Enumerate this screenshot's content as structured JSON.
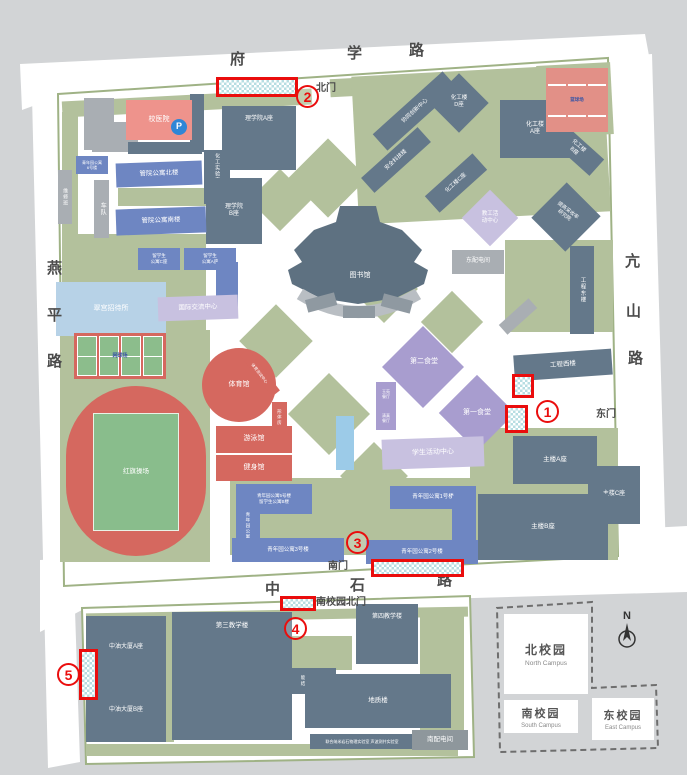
{
  "colors": {
    "background": "#d2d4d6",
    "campus": "#ffffff",
    "lawn": "#b3c19c",
    "campus_border": "#9fb285",
    "academic_building": "#64788a",
    "dormitory": "#6e86c2",
    "hotel": "#b7d2e7",
    "hospital": "#ee938c",
    "sports": "#d5685f",
    "canteen": "#a89dcf",
    "activity": "#c8c1e0",
    "marker_red": "#ea0d0d",
    "marker_fill": "#b7dde2",
    "parking_blue": "#2f86d6"
  },
  "road_labels": [
    {
      "id": "road-fuxue-char-1",
      "text": "府",
      "x": 230,
      "y": 48
    },
    {
      "id": "road-fuxue-char-2",
      "text": "学",
      "x": 347,
      "y": 42
    },
    {
      "id": "road-fuxue-char-3",
      "text": "路",
      "x": 409,
      "y": 39
    },
    {
      "id": "road-yanping-char-1",
      "text": "燕",
      "x": 47,
      "y": 257
    },
    {
      "id": "road-yanping-char-2",
      "text": "平",
      "x": 47,
      "y": 304
    },
    {
      "id": "road-yanping-char-3",
      "text": "路",
      "x": 47,
      "y": 350
    },
    {
      "id": "road-kangshan-char-1",
      "text": "亢",
      "x": 625,
      "y": 250
    },
    {
      "id": "road-kangshan-char-2",
      "text": "山",
      "x": 626,
      "y": 300
    },
    {
      "id": "road-kangshan-char-3",
      "text": "路",
      "x": 628,
      "y": 347
    },
    {
      "id": "road-zhongshi-char-1",
      "text": "中",
      "x": 265,
      "y": 578
    },
    {
      "id": "road-zhongshi-char-2",
      "text": "石",
      "x": 350,
      "y": 574
    },
    {
      "id": "road-zhongshi-char-3",
      "text": "路",
      "x": 437,
      "y": 569
    }
  ],
  "gates": [
    {
      "id": "gate-north",
      "label": "北门",
      "x": 316,
      "y": 79
    },
    {
      "id": "gate-east",
      "label": "东门",
      "x": 596,
      "y": 405
    },
    {
      "id": "gate-south",
      "label": "南门",
      "x": 328,
      "y": 557
    },
    {
      "id": "gate-south-campus-north",
      "label": "南校园北门",
      "x": 316,
      "y": 593
    }
  ],
  "buildings": [
    {
      "id": "building-unnamed-1",
      "label": "",
      "x": 84,
      "y": 98,
      "w": 30,
      "h": 52,
      "t": "plain"
    },
    {
      "id": "building-unnamed-2",
      "label": "",
      "x": 92,
      "y": 122,
      "w": 46,
      "h": 30,
      "t": "plain"
    },
    {
      "id": "building-unnamed-3",
      "label": "",
      "x": 128,
      "y": 142,
      "w": 74,
      "h": 12,
      "t": "academic"
    },
    {
      "id": "building-unnamed-4",
      "label": "",
      "x": 190,
      "y": 94,
      "w": 14,
      "h": 58,
      "t": "academic"
    },
    {
      "id": "building-xiaoyiyuan",
      "label": "校医院",
      "x": 126,
      "y": 100,
      "w": 66,
      "h": 40,
      "t": "pink",
      "fs": 7
    },
    {
      "id": "parking-icon",
      "label": "P",
      "x": 171,
      "y": 119,
      "w": 16,
      "h": 16,
      "t": "picon",
      "fs": 9
    },
    {
      "id": "building-lixueyuan-a",
      "label": "理学院A座",
      "x": 222,
      "y": 106,
      "w": 74,
      "h": 64,
      "t": "academic",
      "fs": 6,
      "lp": "top"
    },
    {
      "id": "building-huagong-shiyan",
      "label": "化工实验实践中心",
      "x": 204,
      "y": 150,
      "w": 26,
      "h": 54,
      "t": "academic",
      "fs": 5,
      "vert": true
    },
    {
      "id": "building-lixueyuan-b",
      "label": "理学院\nB座",
      "x": 206,
      "y": 178,
      "w": 56,
      "h": 66,
      "t": "academic",
      "fs": 6
    },
    {
      "id": "building-weixiuban",
      "label": "维修班",
      "x": 58,
      "y": 170,
      "w": 14,
      "h": 54,
      "t": "plain",
      "fs": 5,
      "vert": true
    },
    {
      "id": "building-chedui",
      "label": "车队",
      "x": 94,
      "y": 180,
      "w": 15,
      "h": 58,
      "t": "plain",
      "fs": 6,
      "vert": true
    },
    {
      "id": "building-guanyuan-gongyu-bei",
      "label": "管院公寓北楼",
      "x": 116,
      "y": 162,
      "w": 86,
      "h": 24,
      "t": "dorm",
      "fs": 6.5,
      "rot": -2
    },
    {
      "id": "building-guanyuan-gongyu-nan",
      "label": "管院公寓南楼",
      "x": 116,
      "y": 208,
      "w": 90,
      "h": 26,
      "t": "dorm",
      "fs": 6.5,
      "rot": -2
    },
    {
      "id": "building-qingnianyuan-gongyu-6",
      "label": "青年园公寓\n6号楼",
      "x": 76,
      "y": 156,
      "w": 32,
      "h": 18,
      "t": "dorm",
      "fs": 4
    },
    {
      "id": "building-liuxuesheng-gongyu-c",
      "label": "留学生\n公寓C座",
      "x": 138,
      "y": 248,
      "w": 42,
      "h": 22,
      "t": "dorm",
      "fs": 4.5
    },
    {
      "id": "building-liuxuesheng-gongyu-a",
      "label": "留学生\n公寓A座",
      "x": 184,
      "y": 248,
      "w": 52,
      "h": 22,
      "t": "dorm",
      "fs": 4.5
    },
    {
      "id": "building-liuxuesheng-gongyu-a-wing",
      "label": "",
      "x": 216,
      "y": 262,
      "w": 22,
      "h": 52,
      "t": "dorm"
    },
    {
      "id": "building-cuigong-zhaodaisuo",
      "label": "翠宫招待所",
      "x": 56,
      "y": 282,
      "w": 110,
      "h": 54,
      "t": "lightblue",
      "fs": 7
    },
    {
      "id": "building-guoji-jiaoliu-zhongxin",
      "label": "国际交流中心",
      "x": 158,
      "y": 296,
      "w": 80,
      "h": 24,
      "t": "lightpurple",
      "fs": 6.5,
      "rot": -2
    },
    {
      "id": "tennis-courts",
      "label": "网球场",
      "x": 74,
      "y": 333,
      "w": 92,
      "h": 46,
      "t": "tennis",
      "fs": 5
    },
    {
      "id": "hongqi-track",
      "label": "",
      "x": 66,
      "y": 386,
      "w": 140,
      "h": 170,
      "t": "track"
    },
    {
      "id": "hongqi-caochang",
      "label": "红旗操场",
      "x": 93,
      "y": 413,
      "w": 86,
      "h": 118,
      "t": "pitch",
      "fs": 6.5
    },
    {
      "id": "building-tiyuguan",
      "label": "体育馆",
      "x": 202,
      "y": 348,
      "w": 74,
      "h": 74,
      "t": "red",
      "fs": 7,
      "circle": true
    },
    {
      "id": "building-tiyu-ceshi-zhongxin",
      "label": "体育测试中心",
      "x": 234,
      "y": 368,
      "w": 52,
      "h": 10,
      "t": "red",
      "fs": 4,
      "rot": 52
    },
    {
      "id": "building-xingtifang",
      "label": "形体房",
      "x": 272,
      "y": 402,
      "w": 15,
      "h": 30,
      "t": "red",
      "fs": 4.5,
      "vert": true
    },
    {
      "id": "building-youyongguan",
      "label": "游泳馆",
      "x": 216,
      "y": 426,
      "w": 76,
      "h": 27,
      "t": "red",
      "fs": 7
    },
    {
      "id": "building-jianshenguan",
      "label": "健身馆",
      "x": 216,
      "y": 455,
      "w": 76,
      "h": 26,
      "t": "red",
      "fs": 7
    },
    {
      "id": "pond",
      "label": "",
      "x": 336,
      "y": 416,
      "w": 18,
      "h": 54,
      "t": "water"
    },
    {
      "id": "library-label",
      "label": "图书馆",
      "x": 338,
      "y": 270,
      "w": 44,
      "h": 12,
      "t": "label",
      "fs": 7
    },
    {
      "id": "building-dier-shitang",
      "label": "",
      "x": 394,
      "y": 338,
      "w": 58,
      "h": 58,
      "t": "canteen",
      "rot": 45
    },
    {
      "id": "dier-shitang-label",
      "label": "第二食堂",
      "x": 398,
      "y": 356,
      "w": 52,
      "h": 12,
      "t": "label",
      "fs": 7
    },
    {
      "id": "building-yuyuan-canting",
      "label": "玉苑\n餐厅",
      "x": 376,
      "y": 382,
      "w": 20,
      "h": 24,
      "t": "canteen",
      "fs": 4
    },
    {
      "id": "building-qingzhen-canting",
      "label": "清真\n餐厅",
      "x": 376,
      "y": 406,
      "w": 20,
      "h": 24,
      "t": "canteen",
      "fs": 4
    },
    {
      "id": "building-diyi-shitang",
      "label": "",
      "x": 450,
      "y": 386,
      "w": 54,
      "h": 54,
      "t": "canteen",
      "rot": 45
    },
    {
      "id": "diyi-shitang-label",
      "label": "第一食堂",
      "x": 452,
      "y": 407,
      "w": 50,
      "h": 12,
      "t": "label",
      "fs": 7
    },
    {
      "id": "building-xuesheng-huodong-zhongxin",
      "label": "学生活动中心",
      "x": 382,
      "y": 438,
      "w": 102,
      "h": 30,
      "t": "lightpurple",
      "fs": 7,
      "rot": -2
    },
    {
      "id": "building-jiaogong-huodong-zhongxin",
      "label": "",
      "x": 470,
      "y": 198,
      "w": 40,
      "h": 40,
      "t": "lightpurple",
      "rot": 45
    },
    {
      "id": "jiaogong-huodong-label",
      "label": "教工活\n动中心",
      "x": 472,
      "y": 206,
      "w": 36,
      "h": 24,
      "t": "label",
      "fs": 5.5
    },
    {
      "id": "building-dongpeidianjian",
      "label": "东配电间",
      "x": 452,
      "y": 250,
      "w": 52,
      "h": 24,
      "t": "plain",
      "fs": 6
    },
    {
      "id": "building-tigao-caishoulv",
      "label": "",
      "x": 542,
      "y": 192,
      "w": 48,
      "h": 50,
      "t": "academic",
      "rot": 45
    },
    {
      "id": "tigao-caishoulv-label",
      "label": "提高采收率\n研究院",
      "x": 540,
      "y": 202,
      "w": 52,
      "h": 22,
      "t": "label",
      "fs": 5,
      "rot": 38
    },
    {
      "id": "building-huagonglou-a",
      "label": "化工楼\nA座",
      "x": 500,
      "y": 100,
      "w": 70,
      "h": 58,
      "t": "academic",
      "fs": 6
    },
    {
      "id": "building-huagonglou-b",
      "label": "化工楼\nB座",
      "x": 548,
      "y": 138,
      "w": 56,
      "h": 22,
      "t": "academic",
      "fs": 5.5,
      "rot": 42
    },
    {
      "id": "building-huagonglou-c",
      "label": "化工楼C座",
      "x": 424,
      "y": 172,
      "w": 64,
      "h": 22,
      "t": "academic",
      "fs": 5.5,
      "rot": -42
    },
    {
      "id": "building-huagonglou-d",
      "label": "",
      "x": 438,
      "y": 82,
      "w": 42,
      "h": 42,
      "t": "academic",
      "rot": 45
    },
    {
      "id": "huagonglou-d-label",
      "label": "化工楼\nD座",
      "x": 438,
      "y": 90,
      "w": 42,
      "h": 24,
      "t": "label",
      "fs": 5.5
    },
    {
      "id": "building-xietong-chuangxin-zhongxin",
      "label": "协同创新中心",
      "x": 368,
      "y": 100,
      "w": 94,
      "h": 22,
      "t": "academic",
      "fs": 5.5,
      "rot": -42
    },
    {
      "id": "building-anquan-kejilou",
      "label": "安全科技楼",
      "x": 358,
      "y": 150,
      "w": 76,
      "h": 20,
      "t": "academic",
      "fs": 5.5,
      "rot": -42
    },
    {
      "id": "basketball-courts",
      "label": "篮球场",
      "x": 546,
      "y": 68,
      "w": 62,
      "h": 64,
      "t": "basketball",
      "fs": 4.5
    },
    {
      "id": "building-gongcheng-donglou",
      "label": "工程东楼",
      "x": 570,
      "y": 246,
      "w": 24,
      "h": 88,
      "t": "academic",
      "fs": 5.5,
      "vert": true
    },
    {
      "id": "building-unnamed-5",
      "label": "",
      "x": 498,
      "y": 310,
      "w": 40,
      "h": 13,
      "t": "plain",
      "rot": -42
    },
    {
      "id": "building-gongcheng-xilou",
      "label": "工程西楼",
      "x": 514,
      "y": 352,
      "w": 98,
      "h": 26,
      "t": "academic",
      "fs": 6.5,
      "rot": -4
    },
    {
      "id": "building-zhulou-a",
      "label": "主楼A座",
      "x": 513,
      "y": 436,
      "w": 84,
      "h": 48,
      "t": "academic",
      "fs": 6.5
    },
    {
      "id": "building-zhulou-c",
      "label": "主楼C座",
      "x": 588,
      "y": 466,
      "w": 52,
      "h": 58,
      "t": "academic",
      "fs": 6
    },
    {
      "id": "building-zhulou-b",
      "label": "主楼B座",
      "x": 478,
      "y": 494,
      "w": 130,
      "h": 66,
      "t": "academic",
      "fs": 6.5
    },
    {
      "id": "building-qingnianyuan-gongyu-1",
      "label": "青年园公寓1号楼",
      "x": 390,
      "y": 486,
      "w": 86,
      "h": 23,
      "t": "dorm",
      "fs": 5.5
    },
    {
      "id": "building-qingnianyuan-gongyu-2-wing",
      "label": "",
      "x": 452,
      "y": 496,
      "w": 24,
      "h": 58,
      "t": "dorm"
    },
    {
      "id": "building-qingnianyuan-gongyu-2",
      "label": "青年园公寓2号楼",
      "x": 366,
      "y": 540,
      "w": 112,
      "h": 24,
      "t": "dorm",
      "fs": 5.5
    },
    {
      "id": "building-qingnianyuan-gongyu-5",
      "label": "青年园公寓5号楼\n留学生公寓B楼",
      "x": 236,
      "y": 484,
      "w": 76,
      "h": 30,
      "t": "dorm",
      "fs": 4.5
    },
    {
      "id": "building-qingnianyuan-gongyu-4",
      "label": "青年园公寓4号楼",
      "x": 236,
      "y": 506,
      "w": 24,
      "h": 54,
      "t": "dorm",
      "fs": 4.5,
      "vert": true
    },
    {
      "id": "building-qingnianyuan-gongyu-3",
      "label": "青年园公寓3号楼",
      "x": 232,
      "y": 538,
      "w": 112,
      "h": 24,
      "t": "dorm",
      "fs": 5.5
    },
    {
      "id": "building-zhongyou-dasha-a",
      "label": "中油大厦A座",
      "x": 86,
      "y": 616,
      "w": 80,
      "h": 64,
      "t": "academic",
      "fs": 6
    },
    {
      "id": "building-zhongyou-dasha-b",
      "label": "中油大厦B座",
      "x": 86,
      "y": 680,
      "w": 80,
      "h": 62,
      "t": "academic",
      "fs": 6
    },
    {
      "id": "building-disan-jiaoxuelou",
      "label": "第三教学楼",
      "x": 172,
      "y": 612,
      "w": 120,
      "h": 128,
      "t": "academic",
      "fs": 6.5,
      "lp": "top"
    },
    {
      "id": "building-disi-jiaoxuelou",
      "label": "第四教学楼",
      "x": 356,
      "y": 604,
      "w": 62,
      "h": 60,
      "t": "academic",
      "fs": 6,
      "lp": "top"
    },
    {
      "id": "building-nengyuan-cailiao-lab",
      "label": "能源材料微\n结构实验室",
      "x": 288,
      "y": 668,
      "w": 48,
      "h": 26,
      "t": "academic",
      "fs": 4.5
    },
    {
      "id": "building-dizhilou",
      "label": "地质楼",
      "x": 305,
      "y": 674,
      "w": 146,
      "h": 54,
      "t": "academic",
      "fs": 6.5
    },
    {
      "id": "building-lab-bar",
      "label": "联合纳米岩石物理实验室  声波测井实验室",
      "x": 310,
      "y": 734,
      "w": 104,
      "h": 15,
      "t": "academic",
      "fs": 4
    },
    {
      "id": "building-nanpeidianjian",
      "label": "南配电间",
      "x": 412,
      "y": 730,
      "w": 56,
      "h": 20,
      "t": "midgray",
      "fs": 6.5
    }
  ],
  "markers": [
    {
      "id": "marker-1",
      "num": "1",
      "nx": 536,
      "ny": 400,
      "zones": [
        [
          512,
          374,
          22,
          24
        ],
        [
          505,
          405,
          23,
          28
        ]
      ]
    },
    {
      "id": "marker-2",
      "num": "2",
      "nx": 296,
      "ny": 85,
      "zones": [
        [
          216,
          77,
          82,
          20
        ]
      ]
    },
    {
      "id": "marker-3",
      "num": "3",
      "nx": 346,
      "ny": 531,
      "zones": [
        [
          371,
          559,
          93,
          18
        ]
      ]
    },
    {
      "id": "marker-4",
      "num": "4",
      "nx": 284,
      "ny": 617,
      "zones": [
        [
          280,
          596,
          36,
          15
        ]
      ]
    },
    {
      "id": "marker-5",
      "num": "5",
      "nx": 57,
      "ny": 663,
      "zones": [
        [
          79,
          649,
          19,
          51
        ]
      ]
    }
  ],
  "inset": {
    "north_zh": "北校园",
    "north_en": "North Campus",
    "south_zh": "南校园",
    "south_en": "South Campus",
    "east_zh": "东校园",
    "east_en": "East Campus",
    "compass": "N"
  }
}
